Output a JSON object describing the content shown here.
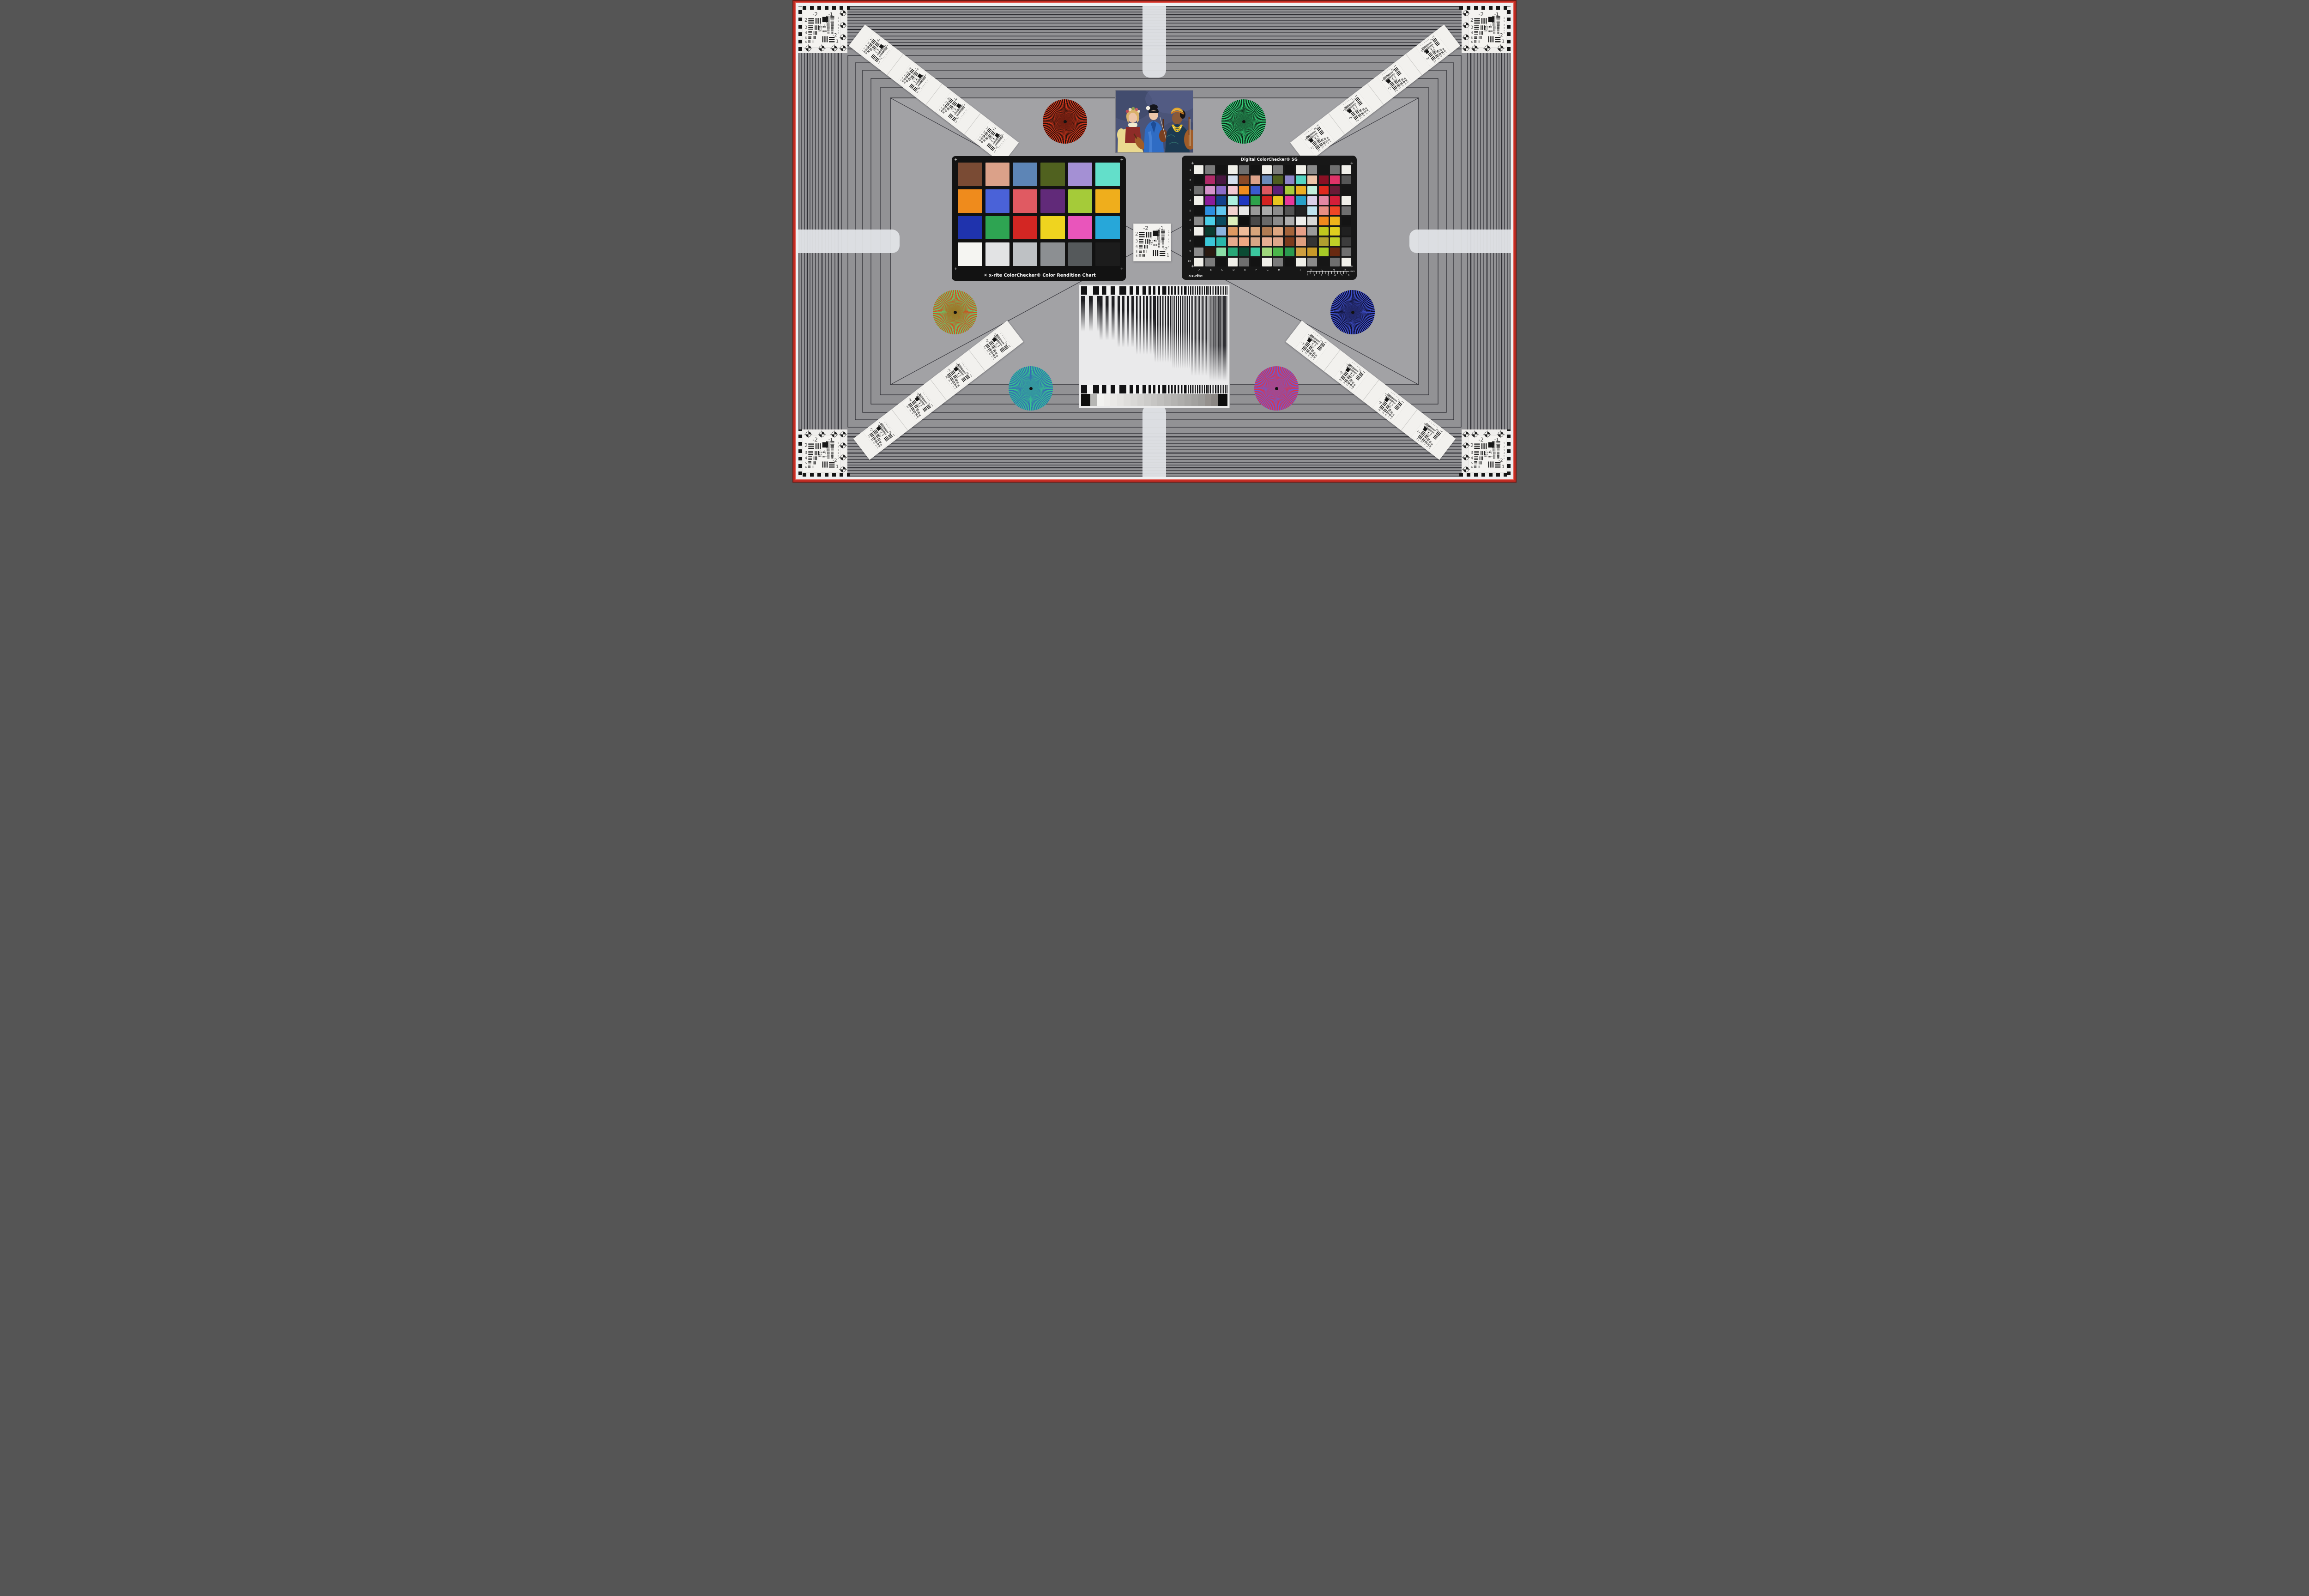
{
  "scene": {
    "background": "#929295",
    "inner_background": "#a2a2a5",
    "frame_line_color": "#26262b",
    "red_border": "#c22d24",
    "red_border_dark": "#6e1a14",
    "white_border": "#eef0f2",
    "edge_bar_color": "#e2e4e7"
  },
  "usaf": {
    "top_left": "-2",
    "top_right": "-1",
    "left_labels": [
      "2",
      "3",
      "4",
      "5",
      "6"
    ],
    "right_labels": [
      "1",
      "2",
      "3",
      "4",
      "5",
      "6"
    ],
    "bottom_labels": [
      "-2",
      "1"
    ],
    "micro_labels": [
      "0",
      "1"
    ]
  },
  "classic": {
    "brand": "x-rite",
    "title": "ColorChecker® Color Rendition Chart",
    "logo_glyph": "✕",
    "patches": [
      "#7a4b34",
      "#dba189",
      "#5d85b6",
      "#50611f",
      "#a490d4",
      "#63dfca",
      "#ef8b1c",
      "#4a62d8",
      "#e05a62",
      "#612a79",
      "#a5cb39",
      "#efae1c",
      "#1f33ad",
      "#2ea452",
      "#d32623",
      "#efd41f",
      "#e955bb",
      "#27a7d9",
      "#f5f5f2",
      "#e2e3e4",
      "#bec1c4",
      "#8c8f92",
      "#55595b",
      "#1c1c1c"
    ]
  },
  "sg": {
    "title": "Digital ColorChecker® SG",
    "brand": "x-rite",
    "logo_glyph": "✕",
    "row_labels": [
      "1",
      "2",
      "3",
      "4",
      "5",
      "6",
      "7",
      "8",
      "9",
      "10"
    ],
    "col_labels": [
      "A",
      "B",
      "C",
      "D",
      "E",
      "F",
      "G",
      "H",
      "I",
      "J",
      "K",
      "L",
      "M",
      "N"
    ],
    "ruler_numbers": [
      "0",
      "1",
      "2",
      "3",
      "4",
      "5",
      "6"
    ],
    "ruler_unit": "mm",
    "patches": [
      "#f0efe9",
      "#7b7b7b",
      "#131313",
      "#f0efe9",
      "#6f6f6f",
      "#131313",
      "#f0efe9",
      "#7b7b7b",
      "#131313",
      "#f0efe9",
      "#8b8b8b",
      "#161616",
      "#6f6f6f",
      "#f0efe9",
      "#131313",
      "#b02a68",
      "#481741",
      "#d4dfee",
      "#8a4a28",
      "#dca28a",
      "#6b8bb9",
      "#4e5e20",
      "#8d85c8",
      "#55d5c2",
      "#efc4a8",
      "#8a1024",
      "#df3368",
      "#565656",
      "#6f6f6f",
      "#d694cb",
      "#8c6bc7",
      "#f4c8d3",
      "#ee8c1e",
      "#3a5bcf",
      "#dc5860",
      "#5b2078",
      "#a7cb3b",
      "#ecae22",
      "#c2efdc",
      "#df291e",
      "#691a36",
      "#161616",
      "#f0efe9",
      "#8b1c9a",
      "#13408b",
      "#adefdf",
      "#1f37bf",
      "#2da24b",
      "#d32221",
      "#e7c51f",
      "#e7389a",
      "#279fc7",
      "#dbd0e9",
      "#e288a3",
      "#d31e39",
      "#f0efe9",
      "#131313",
      "#2d8edf",
      "#61c7ef",
      "#f4d2cf",
      "#e7e7e6",
      "#999999",
      "#ababab",
      "#8c8c8c",
      "#545454",
      "#222222",
      "#bee3ef",
      "#e78f83",
      "#ef4626",
      "#6f6f6f",
      "#8a8a8a",
      "#4bcfe7",
      "#0b4b5f",
      "#deefbb",
      "#101010",
      "#494949",
      "#696969",
      "#8b8b8b",
      "#acacac",
      "#efefec",
      "#d8d8d6",
      "#ef891d",
      "#efb41b",
      "#141414",
      "#f0efe9",
      "#0b3b2f",
      "#8bb3df",
      "#df9961",
      "#efbb99",
      "#d7a57b",
      "#af7b53",
      "#dfa781",
      "#a4643b",
      "#e79f87",
      "#9a9a9a",
      "#bfc71d",
      "#dfcf1f",
      "#202020",
      "#131313",
      "#3bc7d7",
      "#29b7ab",
      "#e7aa8d",
      "#efa783",
      "#d7a787",
      "#e7af93",
      "#dfa78b",
      "#7b3b1d",
      "#df9f7f",
      "#343434",
      "#af9f2f",
      "#bfcf27",
      "#3c3c3c",
      "#8a8a8a",
      "#291910",
      "#8bdfa7",
      "#29a777",
      "#0b4b33",
      "#3bc79f",
      "#9fd77b",
      "#4bb74b",
      "#2a9a4f",
      "#cf9f3f",
      "#c79929",
      "#a7cb27",
      "#692910",
      "#6f6f6f",
      "#f0efe9",
      "#7b7b7b",
      "#131313",
      "#f0efe9",
      "#6f6f6f",
      "#131313",
      "#f0efe9",
      "#7b7b7b",
      "#131313",
      "#f0efe9",
      "#8b8b8b",
      "#161616",
      "#6f6f6f",
      "#f0efe9"
    ]
  },
  "stars": {
    "red_black": {
      "a": "#d8391f",
      "b": "#1c100b",
      "core": "#6e1d10"
    },
    "green_black": {
      "a": "#38d57d",
      "b": "#0b2013",
      "core": "#1d6a3e"
    },
    "red_green": {
      "a": "#d84a20",
      "b": "#62ce72",
      "core": "#9a7a28"
    },
    "blue_black": {
      "a": "#4355d7",
      "b": "#0b0b24",
      "core": "#222868"
    },
    "green_blue": {
      "a": "#38c78e",
      "b": "#3467b5",
      "core": "#35979f"
    },
    "red_blue": {
      "a": "#df3346",
      "b": "#675ed7",
      "core": "#a4498e"
    }
  },
  "wedge": {
    "ramp_steps": [
      "#f2f2f0",
      "#eeedeb",
      "#e9e8e6",
      "#e4e3e1",
      "#dedddb",
      "#d8d7d5",
      "#d2d1cf",
      "#cccbc9",
      "#c6c5c3",
      "#c0bfbd",
      "#bab9b7",
      "#b4b3b1",
      "#aeadab",
      "#a8a7a5",
      "#a2a19f",
      "#9c9b99",
      "#94908d",
      "#8a8683"
    ]
  },
  "portrait": {
    "backdrop": "#4b5478",
    "left_dress": "#ead98f",
    "left_vest": "#8e2c28",
    "middle_kimono": "#2f6cc4",
    "right_garment": "#1c3a52",
    "headwrap": "#e2a52c",
    "necklace": "#e8c028",
    "instrument": "#a05c28"
  }
}
